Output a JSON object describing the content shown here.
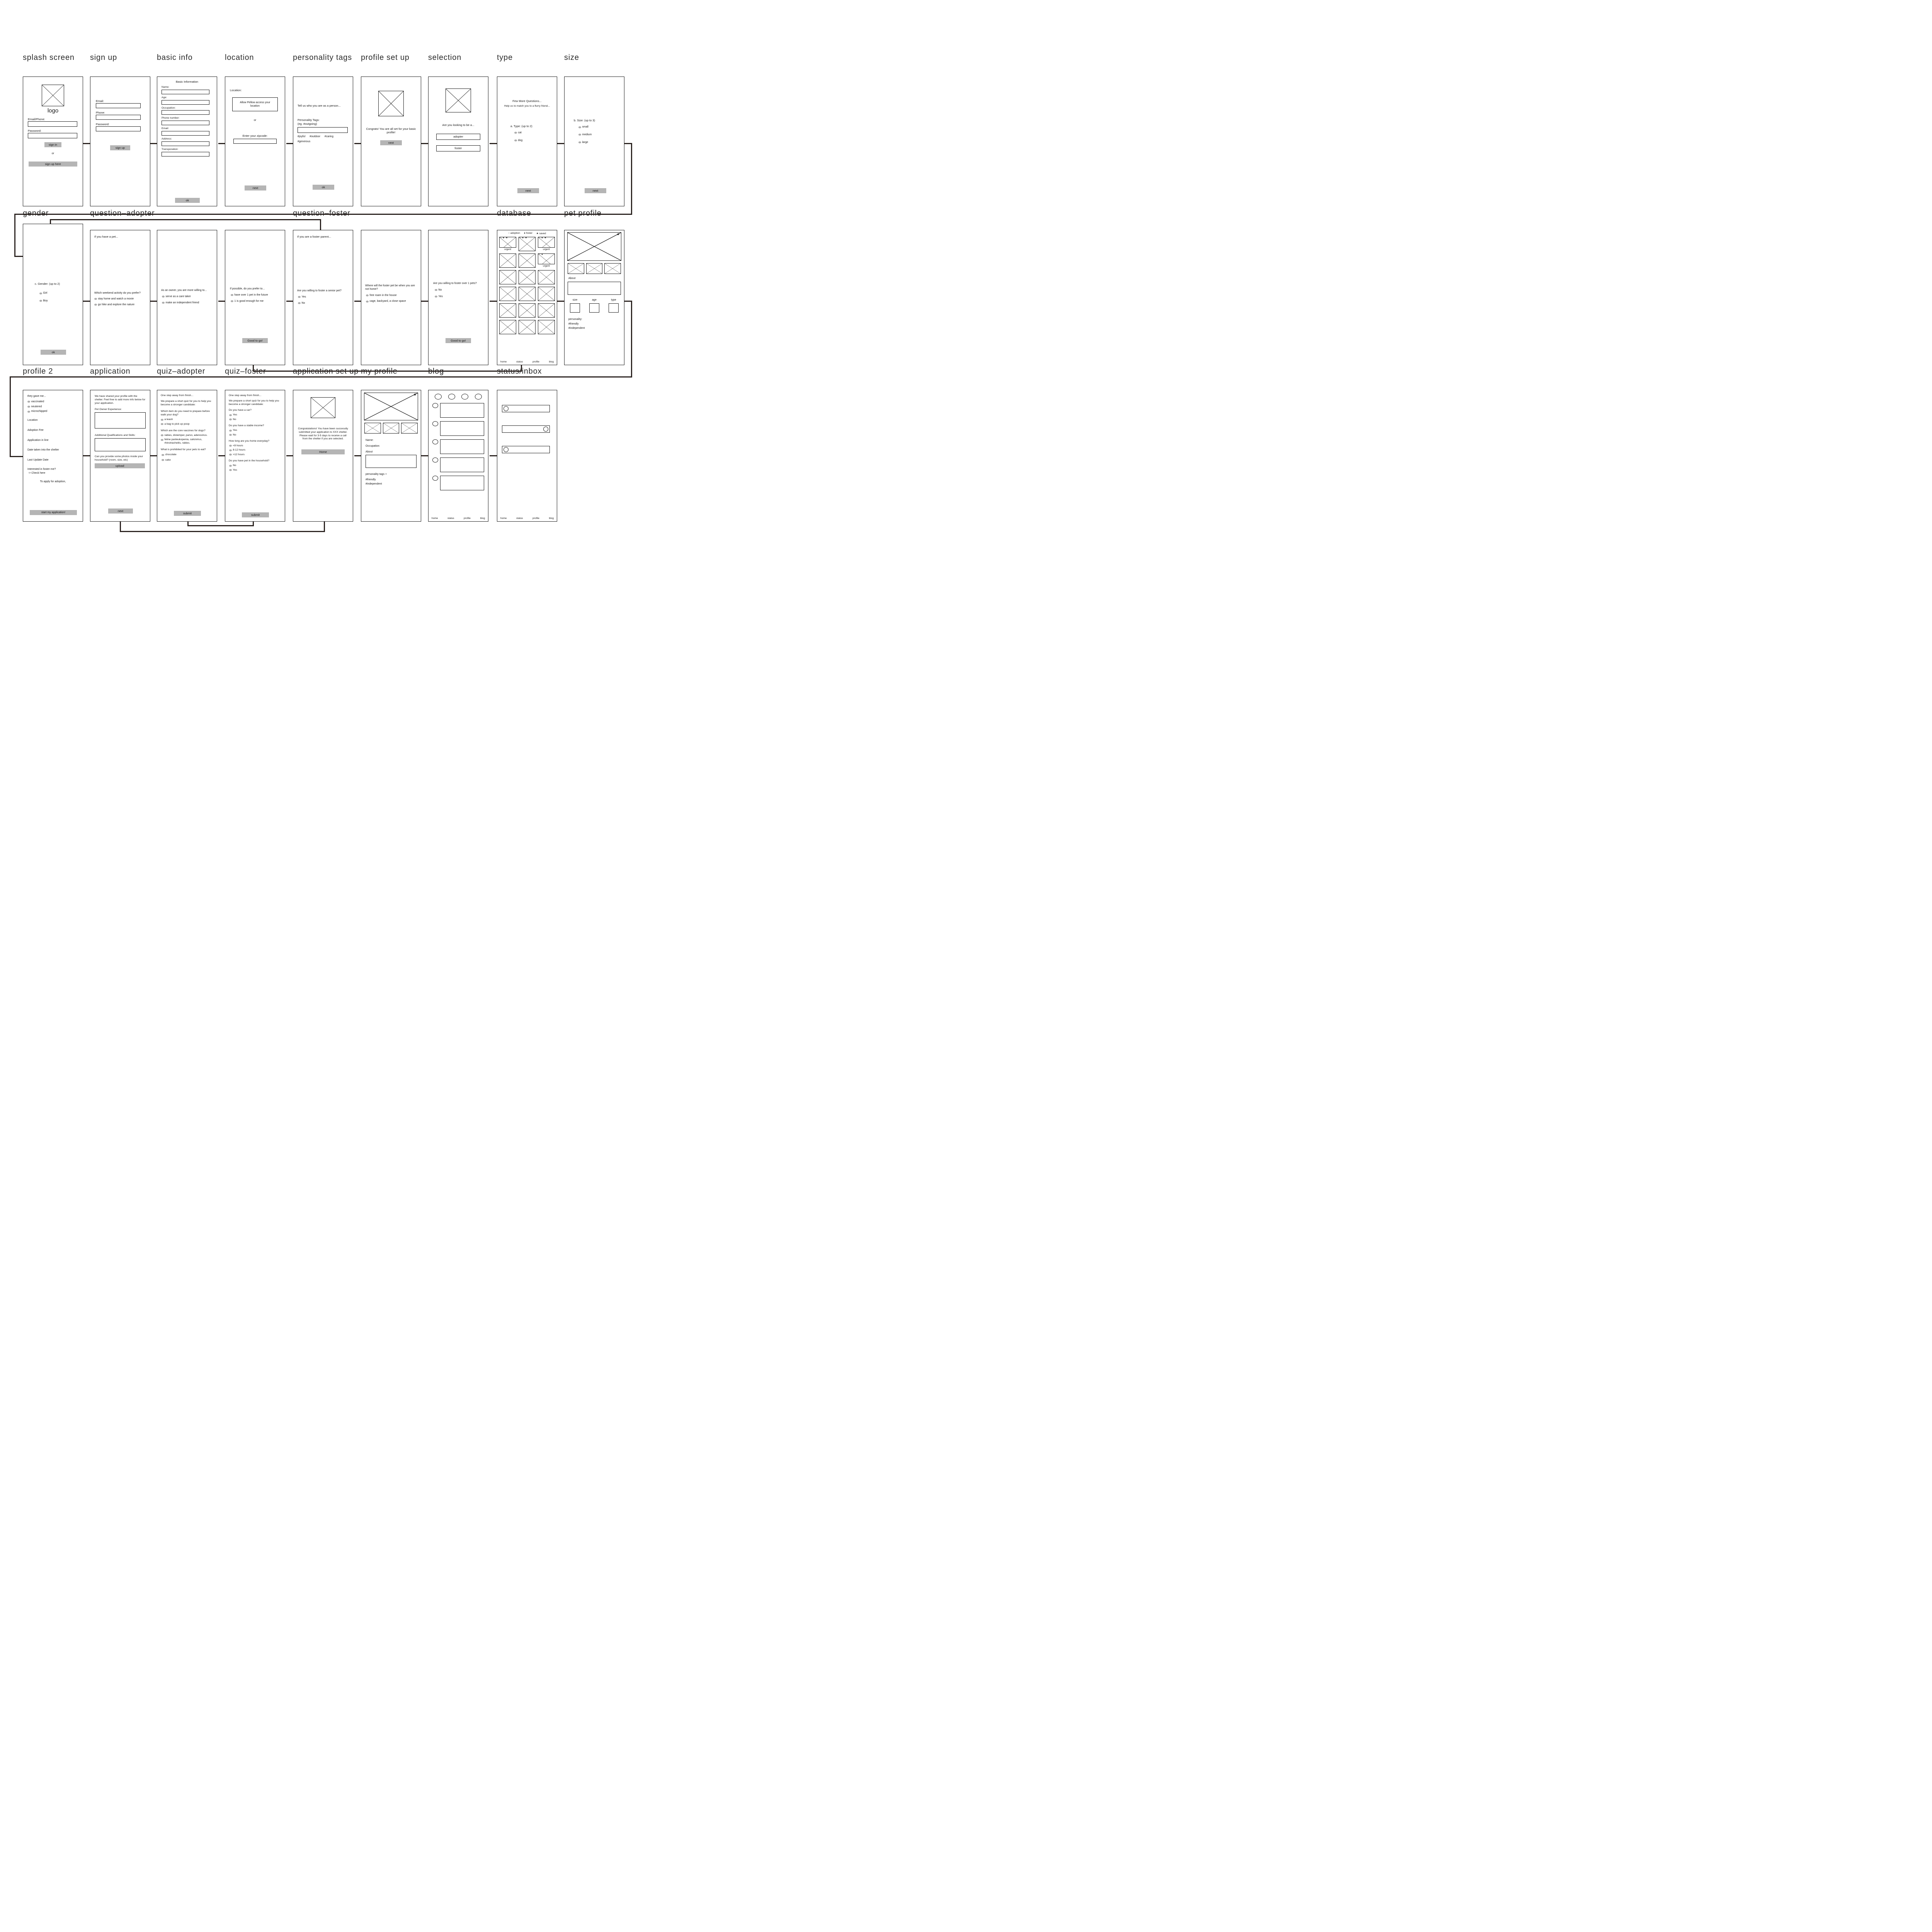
{
  "colors": {
    "button_gray": "#b5b5b5",
    "connector": "#2b2320",
    "radio_gray": "#aeaeae",
    "background": "#ffffff"
  },
  "screens": {
    "splash": {
      "title": "splash screen",
      "logo_label": "logo",
      "email_phone": "Email/Phone:",
      "password": "Password:",
      "sign_in": "sign in",
      "or": "or",
      "sign_up_here": "sign up here"
    },
    "signup": {
      "title": "sign up",
      "email": "Email:",
      "phone": "Phone:",
      "password": "Password:",
      "sign_up": "sign up"
    },
    "basicinfo": {
      "title": "basic info",
      "heading": "Basic Information",
      "fields": [
        "Name:",
        "Age:",
        "Occupation:",
        "Phone number:",
        "Email:",
        "Address:",
        "Transporation:"
      ],
      "ok": "ok"
    },
    "location": {
      "title": "location",
      "label": "Location:",
      "allow": "Allow Pellow access your location",
      "or": "or",
      "zipcode": "Enter your zipcode:",
      "next": "next"
    },
    "ptags": {
      "title": "personality tags",
      "prompt": "Tell us who you are as a person...",
      "label": "Personality Tags:",
      "hint": "(eg. #outgoing)",
      "tags": [
        "#joyful",
        "#outdoor",
        "#caring"
      ],
      "tags2": "#generous",
      "ok": "ok"
    },
    "profilesetup": {
      "title": "profile set up",
      "message": "Congrats! You are all set for your basic profile!",
      "next": "next"
    },
    "selection": {
      "title": "selection",
      "prompt": "Are you looking to be a...",
      "adopter": "adopter",
      "foster": "foster"
    },
    "type": {
      "title": "type",
      "line1": "Few More Questions...",
      "line2": "Help us to match you to a flurry friend...",
      "question": "a. Type: (up to 2)",
      "options": [
        "cat",
        "dog"
      ],
      "next": "next"
    },
    "size": {
      "title": "size",
      "question": "b. Size: (up to 3)",
      "options": [
        "small",
        "medium",
        "large"
      ],
      "next": "next"
    },
    "gender": {
      "title": "gender",
      "question": "c. Gender:  (up to 2)",
      "options": [
        "Girl",
        "Boy"
      ],
      "ok": "ok"
    },
    "qa1": {
      "title": "question–adopter",
      "note": "If you have a pet...",
      "question": "Which weekend activity do you prefer?",
      "options": [
        "stay home and watch a movie",
        "go hike and explore the nature"
      ]
    },
    "qa2": {
      "question": "As an owner, you are more willing to...",
      "options": [
        "serve as a care taker",
        "make an independent friend"
      ]
    },
    "qa3": {
      "question": "If possible, do you prefer to...",
      "options": [
        "have over 1 pet in the future",
        "1 is good enough for me"
      ],
      "button": "Good to go!"
    },
    "qf1": {
      "title": "question–foster",
      "note": "If you are a foster parent...",
      "question": "Are you willing to foster a senior pet?",
      "options": [
        "Yes",
        "No"
      ]
    },
    "qf2": {
      "question": "Where will the foster pet be when you are not home?",
      "options": [
        "free roam in the house",
        "cage, backyard, a close space"
      ]
    },
    "qf3": {
      "question": "Are you willing to foster over 1 pets?",
      "options": [
        "No",
        "Yes"
      ],
      "button": "Good to go!"
    },
    "database": {
      "title": "database",
      "legend": [
        {
          "icon": "○",
          "label": "adoption"
        },
        {
          "icon": "●",
          "label": "foster"
        },
        {
          "icon": "★",
          "label": "saved"
        }
      ],
      "card_icons": "○ ● ★",
      "card_icons_2": "○ ●",
      "urgent": "urgent",
      "nav": [
        "home",
        "status",
        "profile",
        "blog"
      ]
    },
    "petprofile": {
      "title": "pet profile",
      "about": "About",
      "attrs": [
        "size",
        "age",
        "type"
      ],
      "personality": "personality:",
      "tags": [
        "#friendly",
        "#independent"
      ]
    },
    "profile2": {
      "title": "profile 2",
      "intro": "they gave me...",
      "checks": [
        "vaccinated",
        "neutered",
        "microchipped"
      ],
      "lines": [
        "Location",
        "Adoption Fee",
        "Application in line",
        "Date taken into the shelter",
        "Last Update Date"
      ],
      "foster_q": "Interested in foster me?",
      "foster_link": "-> Check here",
      "apply": "To apply for adoption,",
      "start": "start my application!"
    },
    "application": {
      "title": "application",
      "intro": "We have shared your profile with the shelter. Feel free to add more info below for your application.",
      "exp": "Pet Owner Experience:",
      "skills": "Additional Qualifications and Skills:",
      "photos": "Can you provide some photos inside your household? (room, size, etc)",
      "upload": "upload",
      "next": "next"
    },
    "quizadopter": {
      "title": "quiz–adopter",
      "line1": "One step away from finish...",
      "line2": "We prepare a short quiz for you to help you become a stronger candidate:",
      "q1": "Which item do you need to prepare before walk your dog?",
      "q1o": [
        "a leash",
        "a bag to pick up poop"
      ],
      "q2": "Which are the core vaccines for dogs?",
      "q2o": [
        "rabies, distemper, parvo, adenovirus.",
        "feline panleukopenia, calicivirus, rhinotracheitis, rabies."
      ],
      "q3": "What is prohibited for your pets to eat?",
      "q3o": [
        "chocolate",
        "cake"
      ],
      "submit": "submit"
    },
    "quizfoster": {
      "title": "quiz–foster",
      "line1": "One step away from finish...",
      "line2": "We prepare a short quiz for you to help you become a stronger candidate:",
      "q1": "Do you have a car?",
      "q1o": [
        "Yes",
        "No"
      ],
      "q2": "Do you have a stable income?",
      "q2o": [
        "Yes",
        "No"
      ],
      "q3": "How long are you home everyday?",
      "q3o": [
        "<8 hours",
        "8-12 hours",
        ">12 hours"
      ],
      "q4": "Do you have pet in the household?",
      "q4o": [
        "No",
        "Yes"
      ],
      "submit": "submit"
    },
    "appsetup": {
      "title": "application set up",
      "message": "Congratulations! You have been succesully submitted your application to XXX shelter. Please wait for 3-5 days to receive a call from the shelter if you are selected.",
      "home": "Home"
    },
    "myprofile": {
      "title": "my profile",
      "name": "Name:",
      "occupation": "Occupation:",
      "about": "About",
      "personality": "personality tags +",
      "tags": [
        "#friendly",
        "#independent"
      ]
    },
    "blog": {
      "title": "blog",
      "nav": [
        "home",
        "status",
        "profile",
        "blog"
      ]
    },
    "statusinbox": {
      "title": "status/inbox",
      "nav": [
        "home",
        "status",
        "profile",
        "blog"
      ]
    }
  }
}
